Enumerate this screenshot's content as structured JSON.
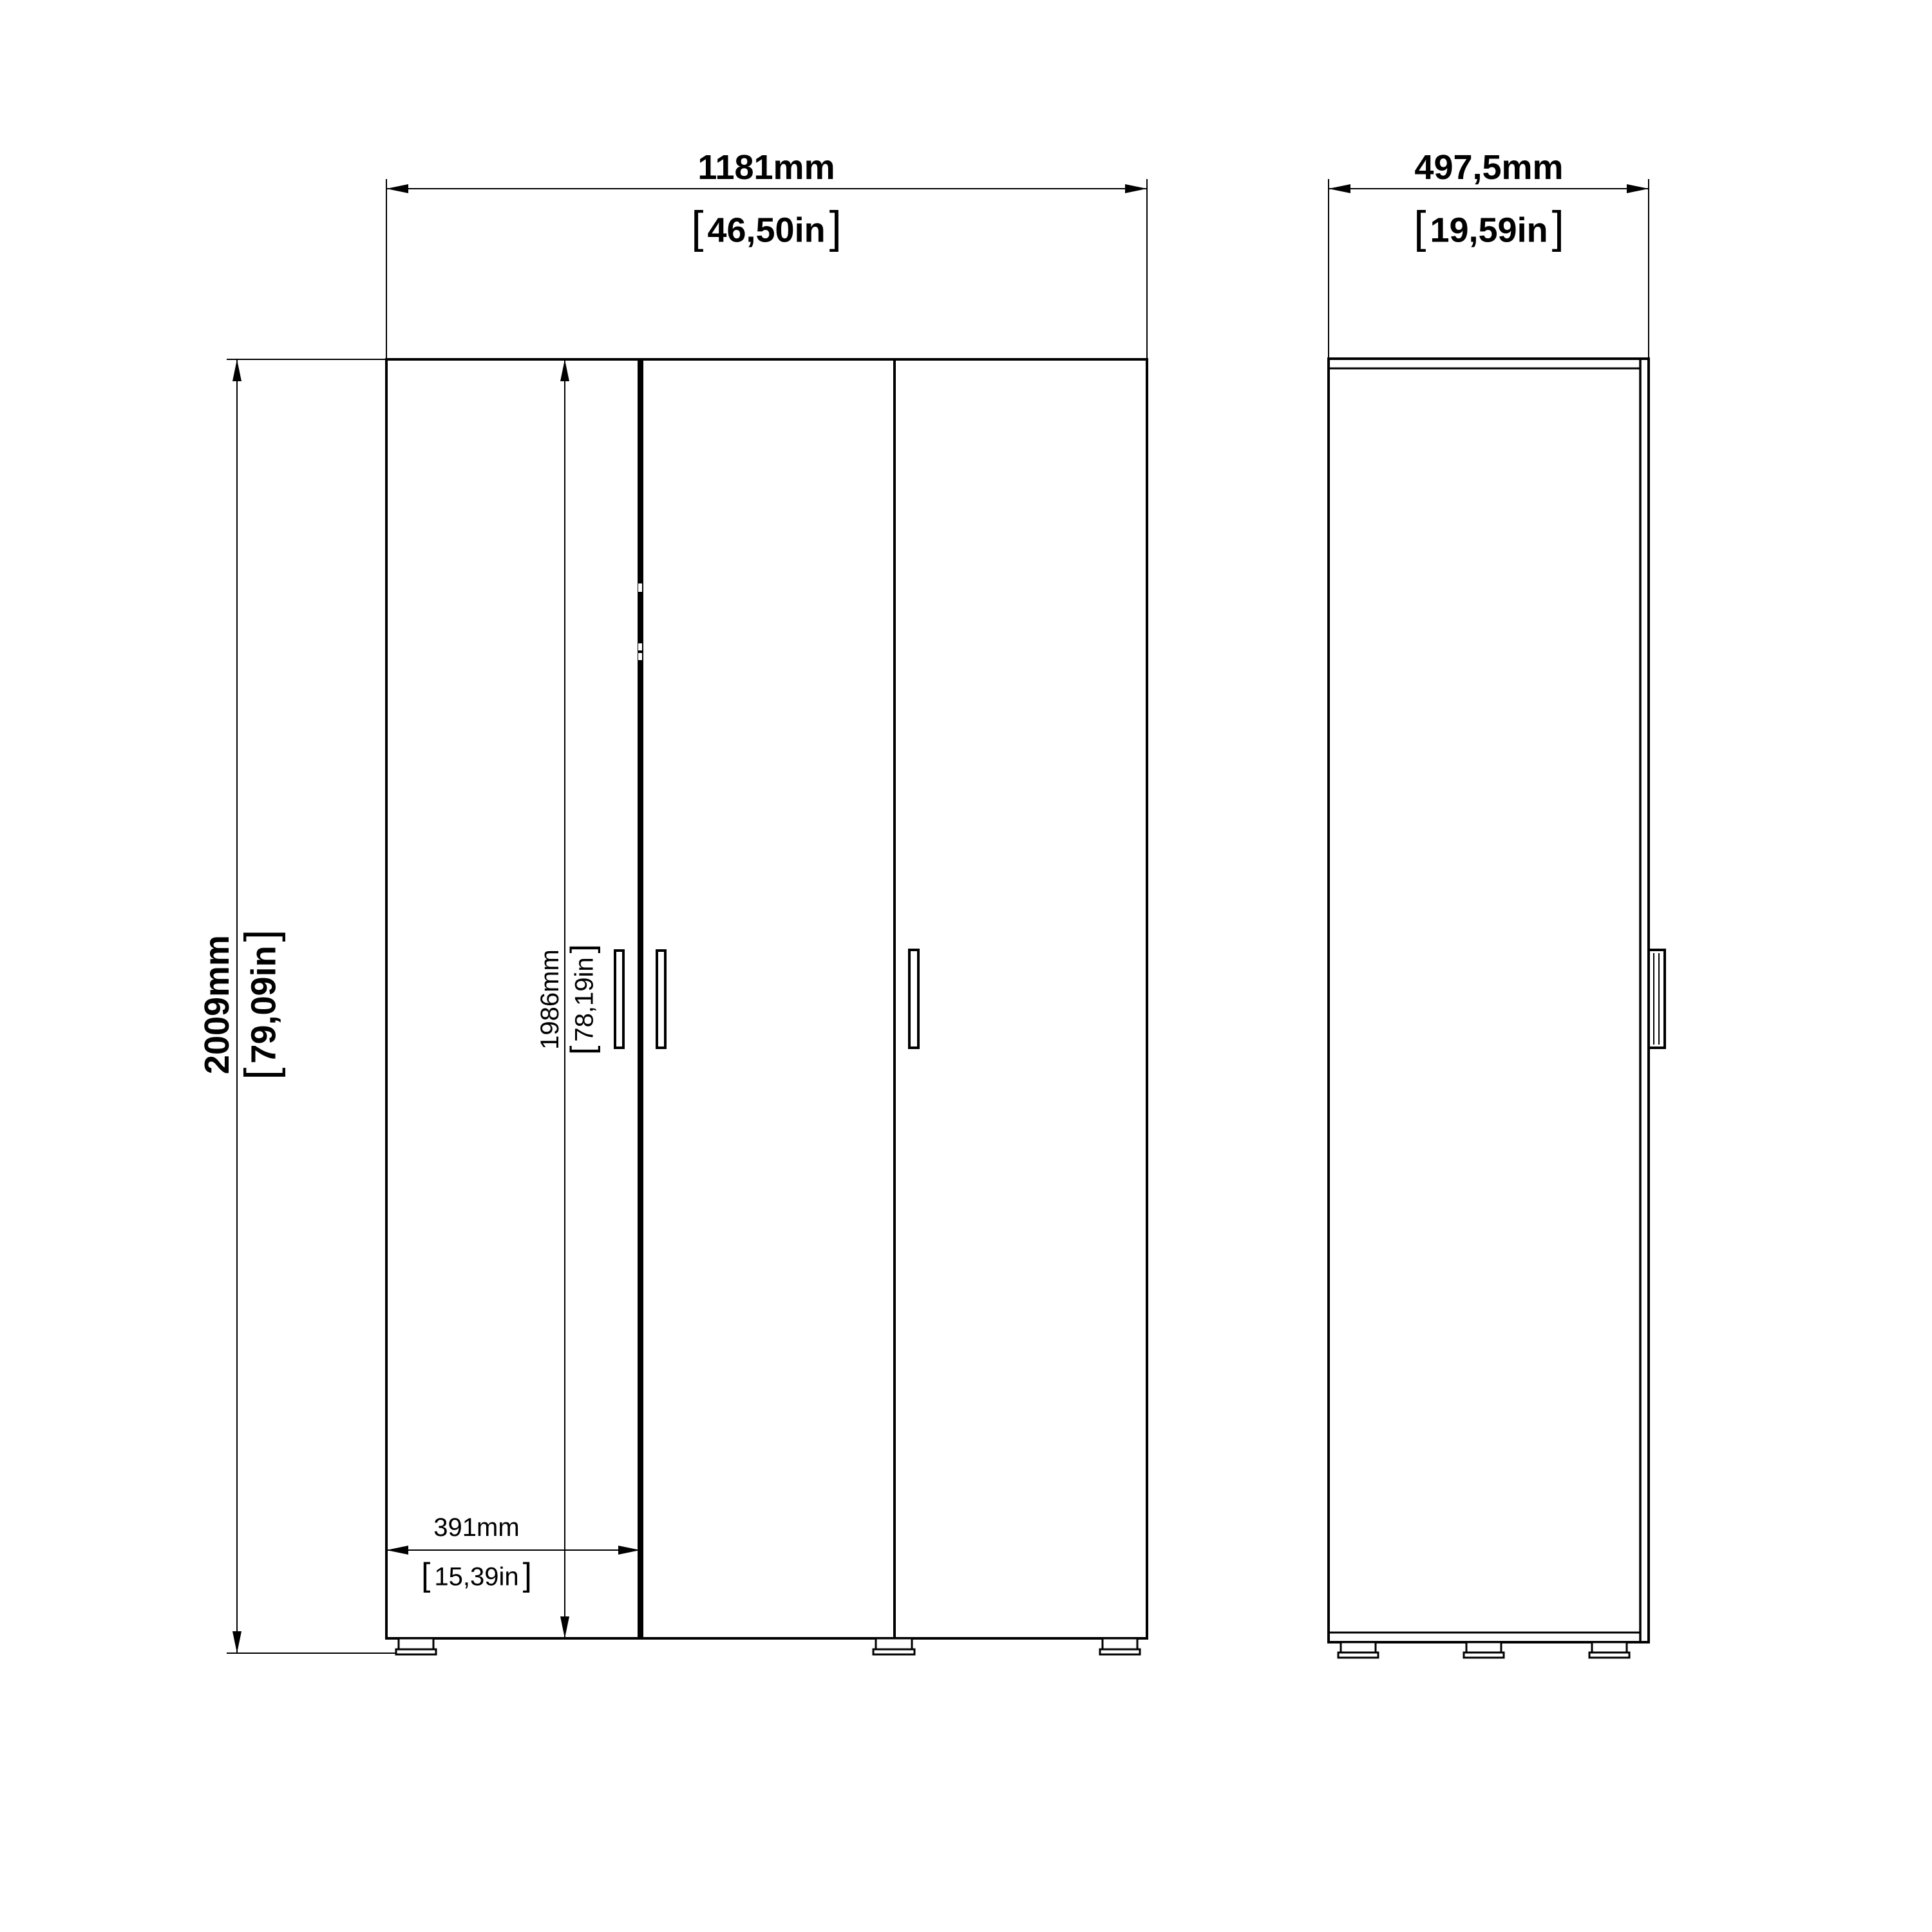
{
  "document": {
    "type": "furniture-dimension-drawing",
    "views": [
      "front-view",
      "side-view"
    ]
  },
  "dims": {
    "overall_width": {
      "mm": "1181mm",
      "in": "46,50in"
    },
    "depth": {
      "mm": "497,5mm",
      "in": "19,59in"
    },
    "overall_height": {
      "mm": "2009mm",
      "in": "79,09in"
    },
    "door_height": {
      "mm": "1986mm",
      "in": "78,19in"
    },
    "door_width": {
      "mm": "391mm",
      "in": "15,39in"
    }
  },
  "punct": {
    "open": "[",
    "close": "]"
  },
  "components": {
    "front_door_count": 3,
    "front_handle_count": 3,
    "front_feet_count": 3,
    "side_feet_count": 3,
    "side_handle_count": 1
  },
  "colors": {
    "line": "#000000",
    "background": "#ffffff"
  }
}
